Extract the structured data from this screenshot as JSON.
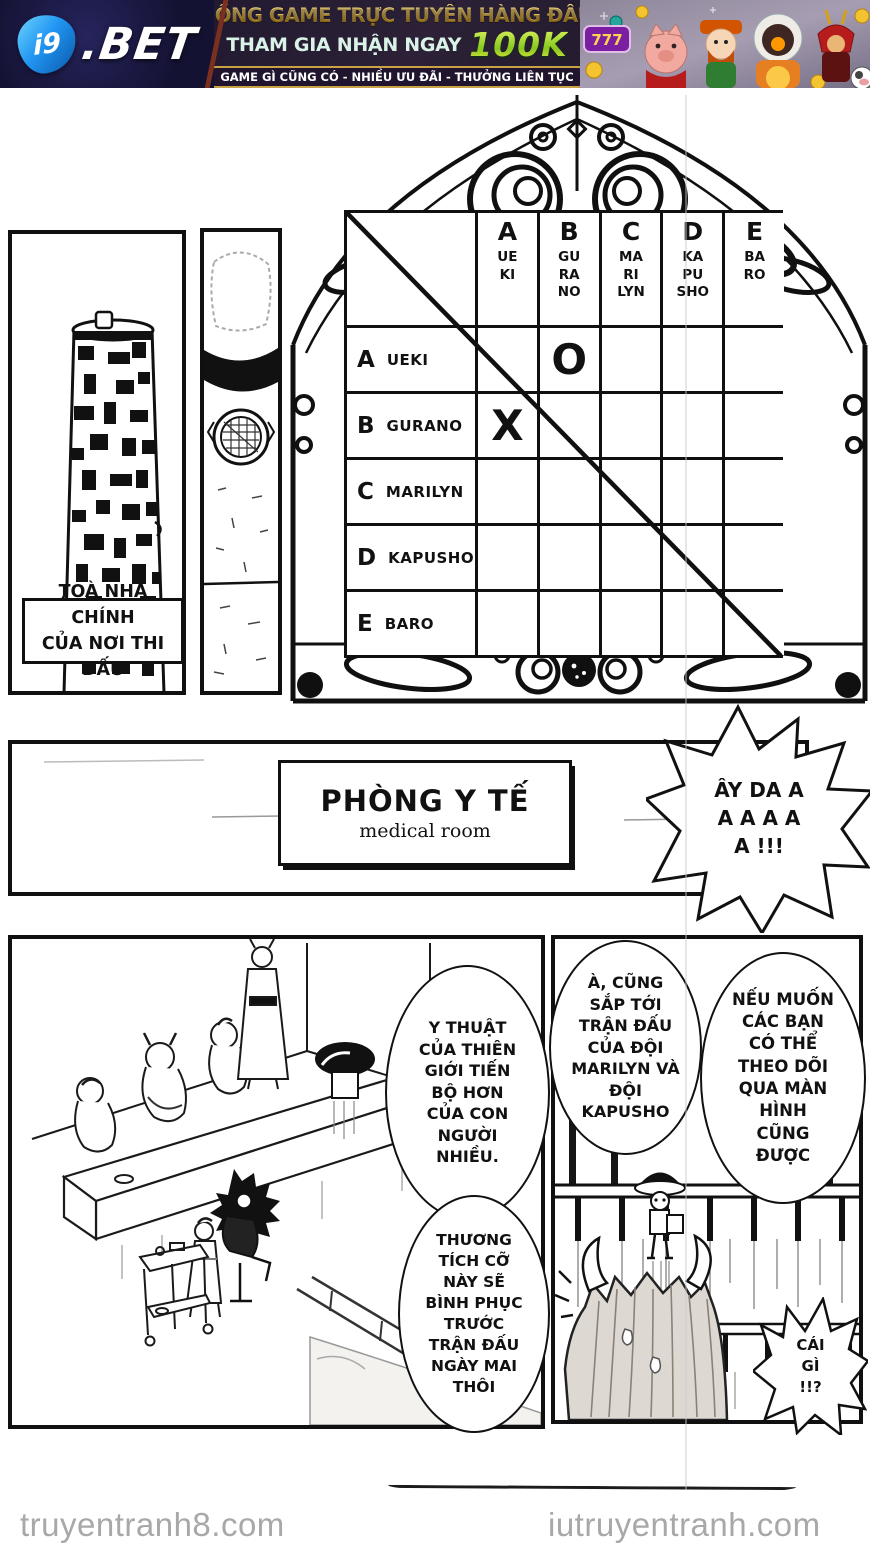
{
  "banner": {
    "brand_i9": "i9",
    "brand_bet": ".BET",
    "headline": "CỔNG GAME TRỰC TUYẾN HÀNG ĐẦU",
    "cta_prefix": "THAM GIA NHẬN NGAY",
    "cta_amount": "100K",
    "tagline": "GAME GÌ CŨNG CÓ - NHIỀU ƯU ĐÃI - THƯỞNG LIÊN TỤC",
    "slot_text": "777",
    "colors": {
      "gold": "#d9a935",
      "lime": "#b9e03c",
      "navy": "#17153a",
      "mint": "#d9f3e7",
      "pill_border": "#c9a245"
    }
  },
  "bracket_table": {
    "columns": [
      {
        "letter": "A",
        "name": "UE\nKI"
      },
      {
        "letter": "B",
        "name": "GU\nRA\nNO"
      },
      {
        "letter": "C",
        "name": "MA\nRI\nLYN"
      },
      {
        "letter": "D",
        "name": "KA\nPU\nSHO"
      },
      {
        "letter": "E",
        "name": "BA\nRO"
      }
    ],
    "rows": [
      {
        "letter": "A",
        "name": "UEKI"
      },
      {
        "letter": "B",
        "name": "GURANO"
      },
      {
        "letter": "C",
        "name": "MARILYN"
      },
      {
        "letter": "D",
        "name": "KAPUSHO"
      },
      {
        "letter": "E",
        "name": "BARO"
      }
    ],
    "marks": {
      "ueki_vs_gurano": "O",
      "gurano_vs_ueki": "X"
    }
  },
  "manga": {
    "building_label": "TOÀ NHÀ CHÍNH\nCỦA NƠI THI ĐẤU",
    "sign_title": "PHÒNG Y TẾ",
    "sign_subtitle": "medical room",
    "bubble_scream": "ÂY DA A\nA A A A\nA  !!!",
    "bubble_medicine": "Y THUẬT\nCỦA THIÊN\nGIỚI TIẾN\nBỘ HƠN\nCỦA CON\nNGƯỜI\nNHIỀU.",
    "bubble_recovery": "THƯƠNG\nTÍCH CỠ\nNÀY SẼ\nBÌNH PHỤC\nTRƯỚC\nTRẬN ĐẤU\nNGÀY MAI\nTHÔI",
    "bubble_next_match": "À, CŨNG\nSẮP TỚI\nTRẬN ĐẤU\nCỦA ĐỘI\nMARILYN VÀ\nĐỘI\nKAPUSHO",
    "bubble_watch": "NẾU MUỐN\nCÁC BẠN\nCÓ THỂ\nTHEO DÕI\nQUA MÀN\nHÌNH\nCŨNG\nĐƯỢC",
    "bubble_what": "CÁI\nGÌ\n!!?"
  },
  "footer": {
    "site_left": "truyentranh8.com",
    "site_right": "iutruyentranh.com"
  }
}
